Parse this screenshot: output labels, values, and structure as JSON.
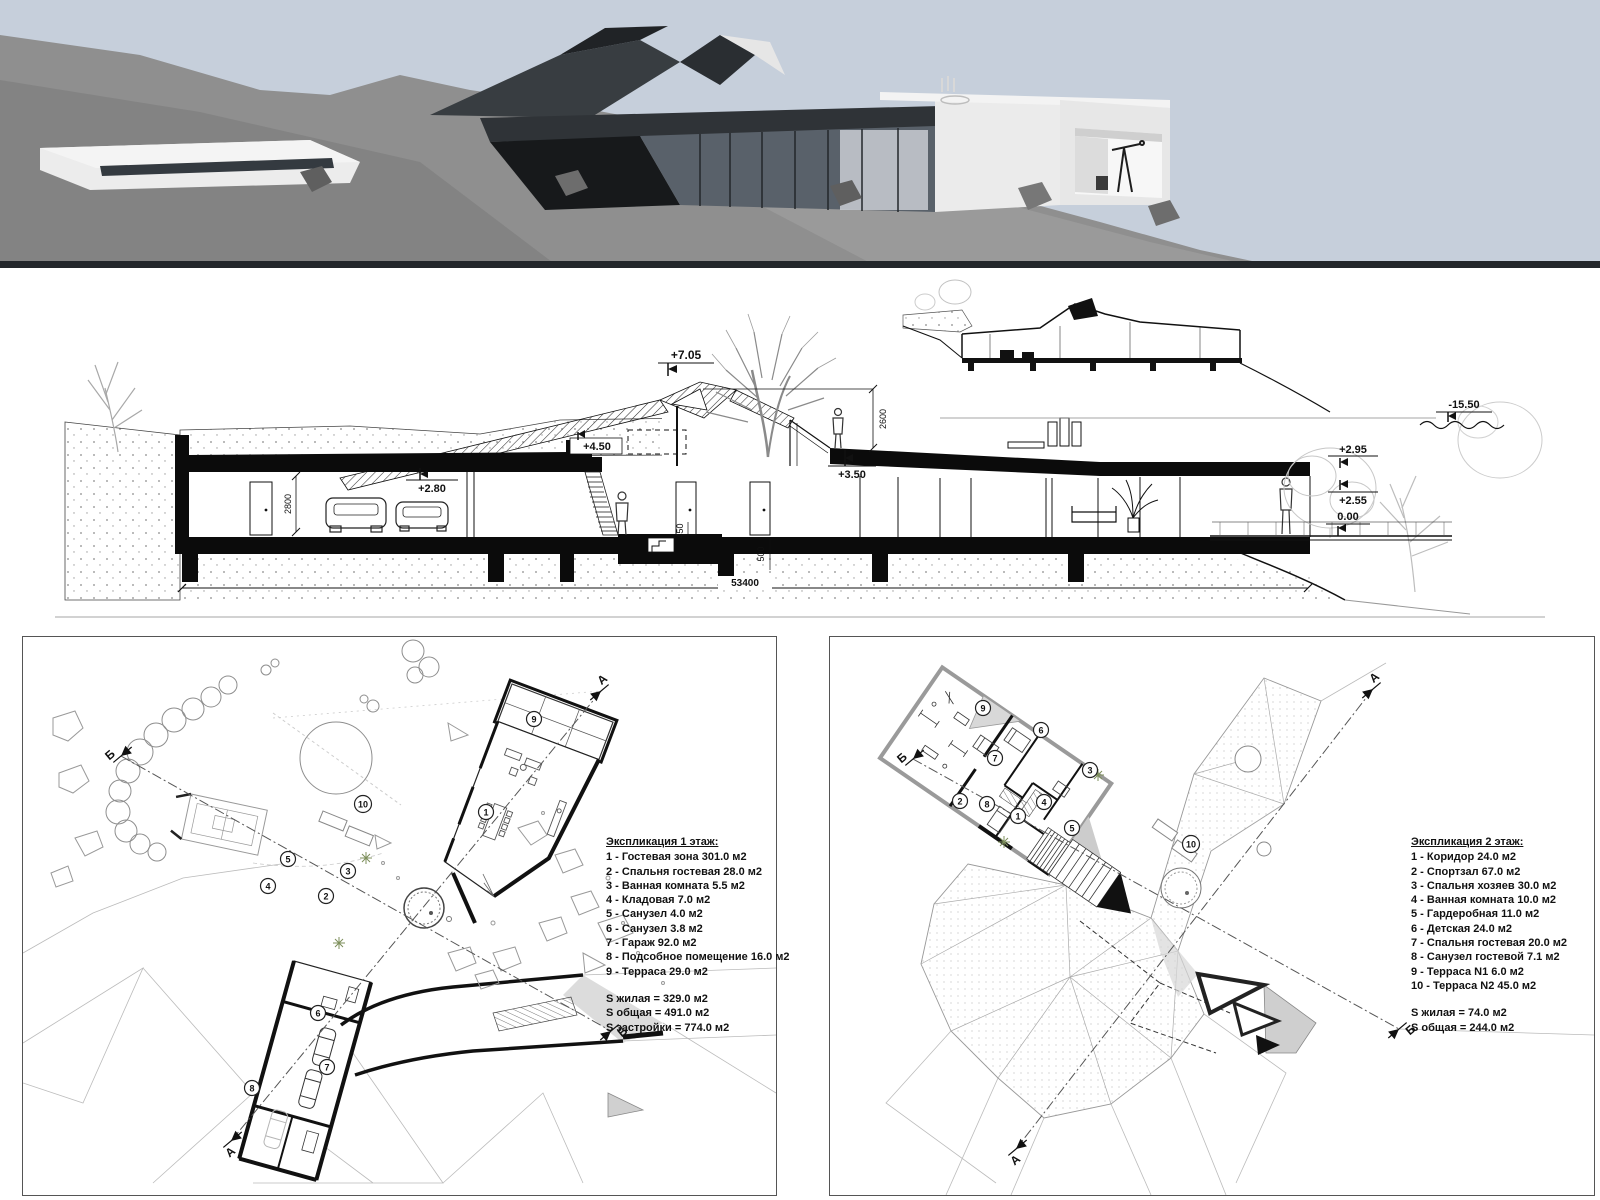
{
  "colors": {
    "sky": "#c6cfdb",
    "hill": "#8f8f8f",
    "hill_dark": "#838383",
    "hill_light": "#9a9a9a",
    "ink": "#111111",
    "roof_dark": "#2f3337",
    "glass": "#59616a"
  },
  "section": {
    "labels": {
      "e705": "+7.05",
      "e450": "+4.50",
      "e280": "+2.80",
      "e350": "+3.50",
      "e295": "+2.95",
      "e255": "+2.55",
      "e000": "0.00",
      "e1550": "-15.50",
      "d2600": "2600",
      "d2800": "2800",
      "d450": "450",
      "d500": "500",
      "d53400": "53400"
    }
  },
  "plan1": {
    "legend": {
      "title": "Экспликация 1 этаж:",
      "items": [
        "1 - Гостевая зона 301.0 м2",
        "2 - Спальня гостевая 28.0 м2",
        "3 - Ванная комната 5.5 м2",
        "4 - Кладовая 7.0 м2",
        "5 - Санузел 4.0 м2",
        "6 - Санузел 3.8 м2",
        "7 - Гараж 92.0 м2",
        "8 - Подсобное помещение 16.0 м2",
        "9 - Терраса 29.0 м2"
      ],
      "totals": [
        "S жилая = 329.0 м2",
        "S общая = 491.0 м2",
        "S застройки = 774.0 м2"
      ]
    },
    "rooms": [
      "1",
      "2",
      "3",
      "4",
      "5",
      "6",
      "7",
      "8",
      "9",
      "10"
    ],
    "markers": {
      "a": "А",
      "b": "Б"
    }
  },
  "plan2": {
    "legend": {
      "title": "Экспликация 2 этаж:",
      "items": [
        "1 - Коридор 24.0 м2",
        "2 - Спортзал 67.0 м2",
        "3 - Спальня хозяев 30.0 м2",
        "4 - Ванная комната 10.0 м2",
        "5 - Гардеробная 11.0 м2",
        "6 - Детская 24.0 м2",
        "7 - Спальня гостевая 20.0 м2",
        "8 - Санузел гостевой 7.1 м2",
        "9 - Терраса N1 6.0 м2",
        "10 - Терраса N2 45.0 м2"
      ],
      "totals": [
        "S жилая = 74.0 м2",
        "S общая = 244.0 м2"
      ]
    },
    "rooms": [
      "1",
      "2",
      "3",
      "4",
      "5",
      "6",
      "7",
      "8",
      "9",
      "10"
    ],
    "markers": {
      "a": "А",
      "b": "Б"
    }
  }
}
